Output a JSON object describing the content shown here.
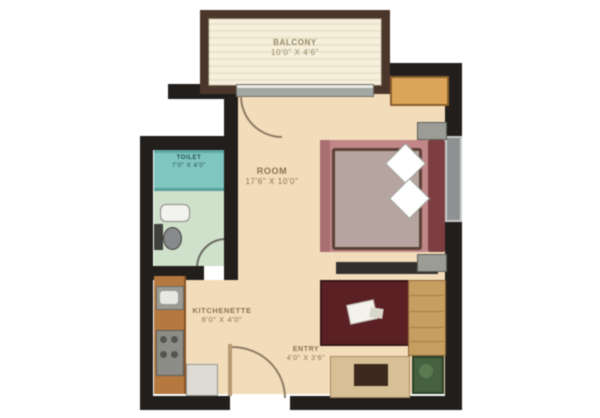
{
  "title": "Studio apartment floor plan",
  "rooms": {
    "balcony": {
      "name": "BALCONY",
      "dims": "10'0\" X 4'6\""
    },
    "room": {
      "name": "ROOM",
      "dims": "17'6\" X 10'0\""
    },
    "toilet": {
      "name": "TOILET",
      "dims": "7'0\" X 4'0\""
    },
    "kitchenette": {
      "name": "KITCHENETTE",
      "dims": "8'0\" X 4'0\""
    },
    "entry": {
      "name": "ENTRY",
      "dims": "4'0\" X 3'6\""
    }
  },
  "furniture": [
    "double-bed",
    "pillows",
    "nightstands",
    "wardrobe",
    "center-table-rug",
    "sofa",
    "bookshelf-unit",
    "plant-table",
    "kitchen-counter",
    "stove",
    "kitchen-sink",
    "refrigerator",
    "toilet",
    "wash-basin",
    "shower"
  ],
  "palette": {
    "wall": "#211e1c",
    "floor": "#f3dcba",
    "balcony_floor": "#f5efdc",
    "balcony_border": "#4a362a",
    "shower_teal": "#7fc5c0",
    "bath_floor": "#cfe0cb",
    "bed_pink": "#c08688",
    "blanket": "#b5a49f",
    "rug_maroon": "#5a2024",
    "wood": "#c79e62",
    "counter_wood": "#b5793f",
    "wardrobe_orange": "#dca457",
    "plant_green": "#45613f"
  }
}
